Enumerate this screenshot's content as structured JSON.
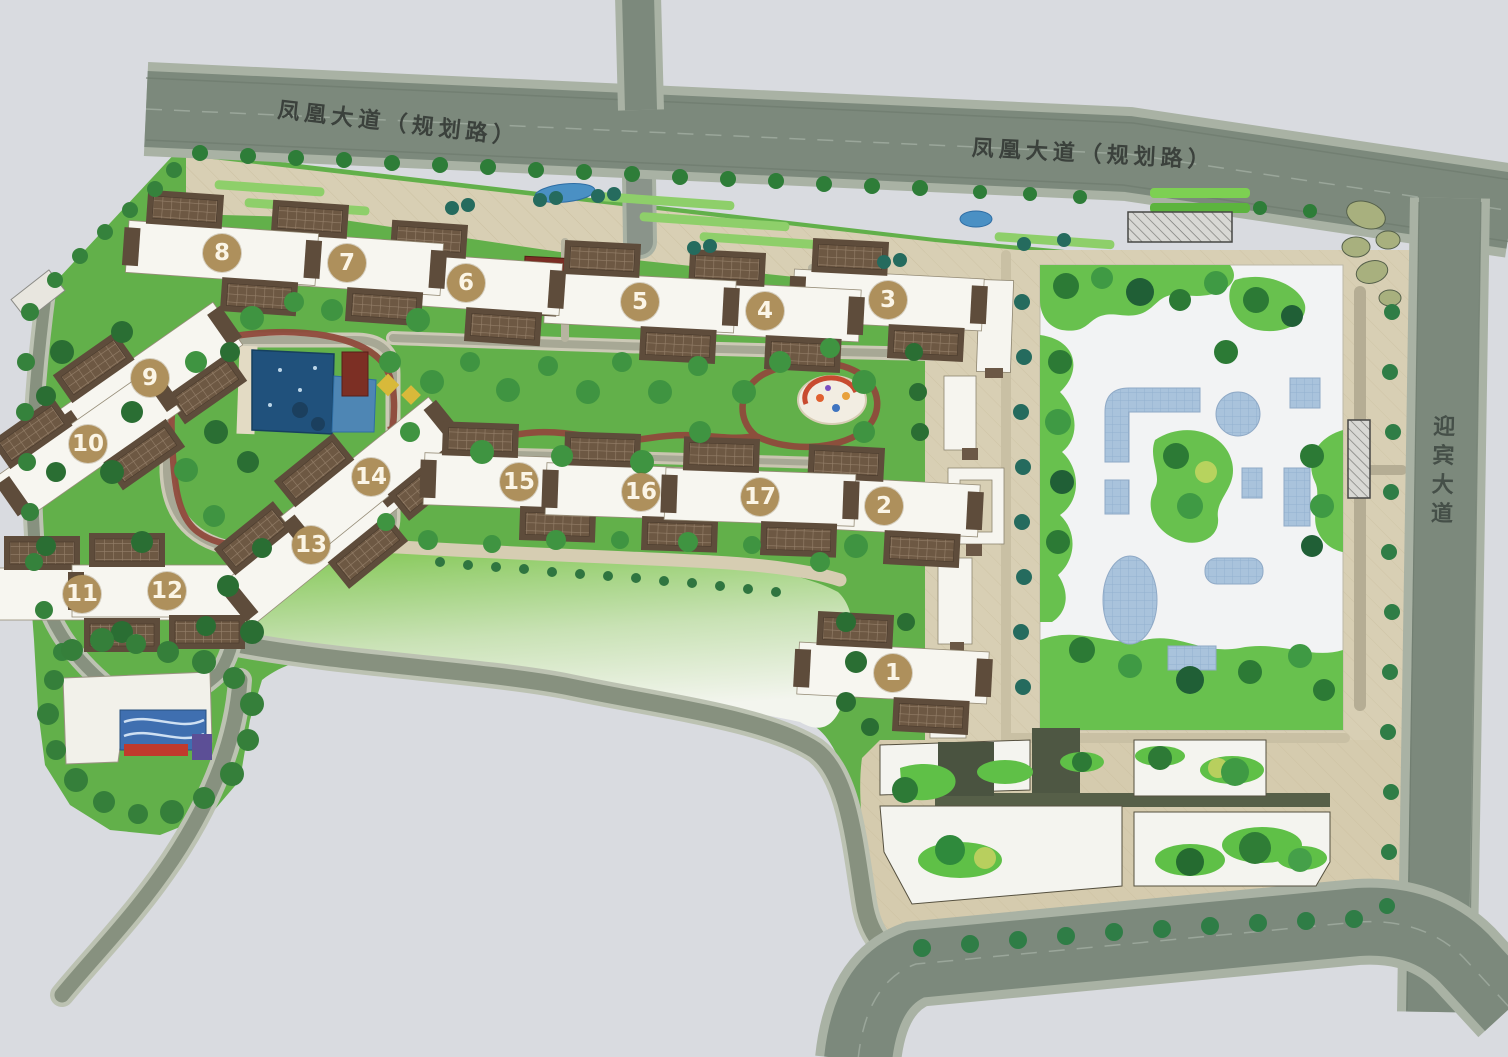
{
  "roads": {
    "phoenix_left": {
      "label": "凤凰大道（规划路）"
    },
    "phoenix_right": {
      "label": "凤凰大道（规划路）"
    },
    "yingbin": {
      "label": "迎宾大道"
    }
  },
  "buildings": [
    {
      "id": "1",
      "x": 893,
      "y": 673,
      "angle": 3
    },
    {
      "id": "2",
      "x": 884,
      "y": 506,
      "angle": 3
    },
    {
      "id": "3",
      "x": 888,
      "y": 300,
      "angle": 3
    },
    {
      "id": "4",
      "x": 765,
      "y": 311,
      "angle": 3
    },
    {
      "id": "5",
      "x": 640,
      "y": 302,
      "angle": 3
    },
    {
      "id": "6",
      "x": 466,
      "y": 283,
      "angle": 4
    },
    {
      "id": "7",
      "x": 347,
      "y": 263,
      "angle": 4
    },
    {
      "id": "8",
      "x": 222,
      "y": 253,
      "angle": 4
    },
    {
      "id": "9",
      "x": 150,
      "y": 378,
      "angle": -35
    },
    {
      "id": "10",
      "x": 88,
      "y": 444,
      "angle": -35
    },
    {
      "id": "11",
      "x": 82,
      "y": 594,
      "angle": 0
    },
    {
      "id": "12",
      "x": 167,
      "y": 591,
      "angle": 0
    },
    {
      "id": "13",
      "x": 311,
      "y": 545,
      "angle": -39
    },
    {
      "id": "14",
      "x": 371,
      "y": 477,
      "angle": -39
    },
    {
      "id": "15",
      "x": 519,
      "y": 482,
      "angle": 2
    },
    {
      "id": "16",
      "x": 641,
      "y": 492,
      "angle": 2
    },
    {
      "id": "17",
      "x": 760,
      "y": 497,
      "angle": 2
    }
  ],
  "palette": {
    "paper": "#d9dbe0",
    "road": "#7c897c",
    "sidewalk": "#a9b2a4",
    "landscape_green": "#62b04a",
    "paving_tan": "#d8cfb4",
    "badge": "#ae905c",
    "pool_blue": "#20517c",
    "plaza_blue": "#a9c3dc",
    "track_red": "#8f4a3c",
    "building_white": "#f7f6f0",
    "building_brown": "#5e4c3b"
  }
}
